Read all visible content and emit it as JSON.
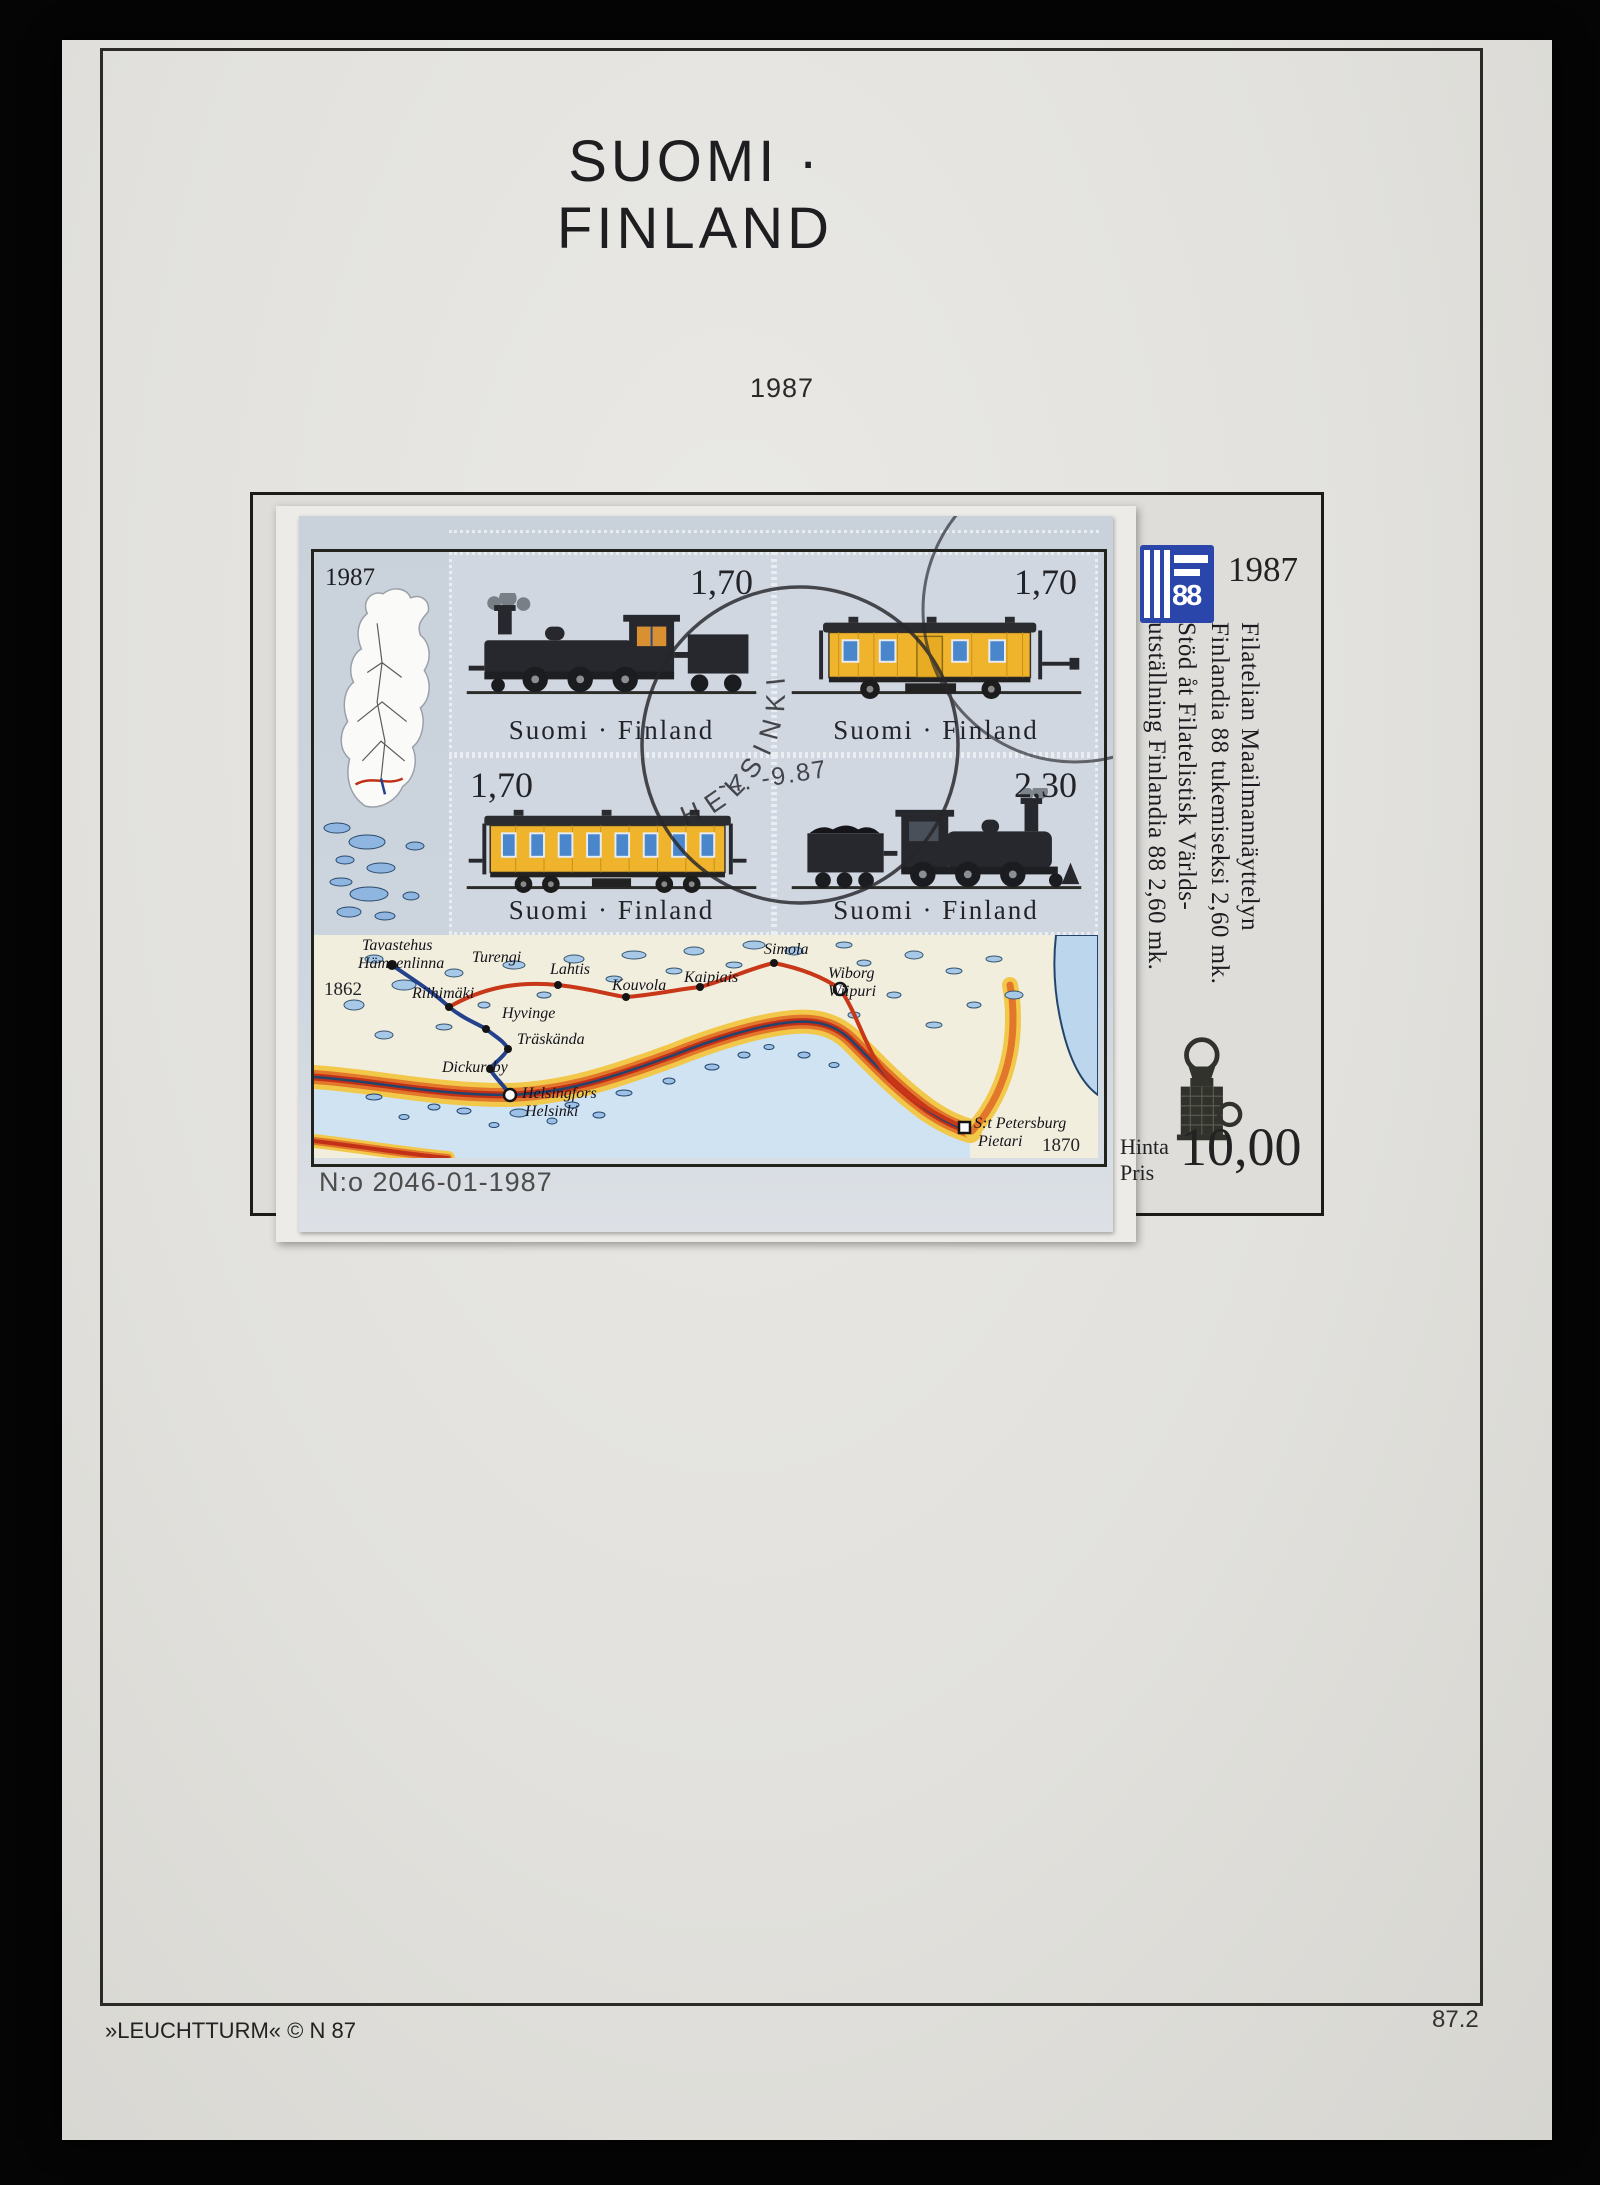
{
  "page": {
    "title": "SUOMI · FINLAND",
    "year_label": "1987",
    "footer_left": "»LEUCHTTURM« © N 87",
    "footer_right": "87.2"
  },
  "sheet": {
    "margin_year": "1987",
    "number": "N:o 2046-01-1987",
    "stamps": [
      {
        "value": "1,70",
        "caption": "Suomi · Finland",
        "subject": "steam locomotive"
      },
      {
        "value": "1,70",
        "caption": "Suomi · Finland",
        "subject": "yellow mail wagon"
      },
      {
        "value": "1,70",
        "caption": "Suomi · Finland",
        "subject": "yellow passenger wagon"
      },
      {
        "value": "2,30",
        "caption": "Suomi · Finland",
        "subject": "locomotive with tender"
      }
    ],
    "postmark": {
      "city": "HELSINKI",
      "date": "-4. -9.87"
    },
    "map": {
      "west_year": "1862",
      "east_year": "1870",
      "cities": [
        {
          "name": "Tavastehus"
        },
        {
          "name": "Hämeenlinna"
        },
        {
          "name": "Turengi"
        },
        {
          "name": "Lahtis"
        },
        {
          "name": "Kouvola"
        },
        {
          "name": "Kaipiais"
        },
        {
          "name": "Simola"
        },
        {
          "name": "Wiborg"
        },
        {
          "name": "Wiipuri"
        },
        {
          "name": "Riihimäki"
        },
        {
          "name": "Hyvinge"
        },
        {
          "name": "Träskända"
        },
        {
          "name": "Dickursby"
        },
        {
          "name": "Helsingfors"
        },
        {
          "name": "Helsinki"
        },
        {
          "name": "S:t Petersburg"
        },
        {
          "name": "Pietari"
        }
      ]
    }
  },
  "info": {
    "logo_year": "1987",
    "logo_digits": "88",
    "lines": [
      "Filatelian Maailmannäyttelyn",
      "Finlandia 88 tukemiseksi 2,60 mk.",
      "Stöd åt Filatelistisk Världs-",
      "utställning Finlandia 88  2,60 mk."
    ],
    "price_fi": "Hinta",
    "price_sv": "Pris",
    "price": "10,00"
  },
  "colors": {
    "accent_blue": "#2a46aa",
    "sheet_blue": "#ccd4de",
    "wagon_yellow": "#efb42c",
    "coast_orange": "#e2762a",
    "coast_red": "#c23018",
    "rail_red": "#c83818",
    "rail_blue": "#24418c",
    "sea": "#cfe3f2",
    "land": "#f2eedd"
  }
}
